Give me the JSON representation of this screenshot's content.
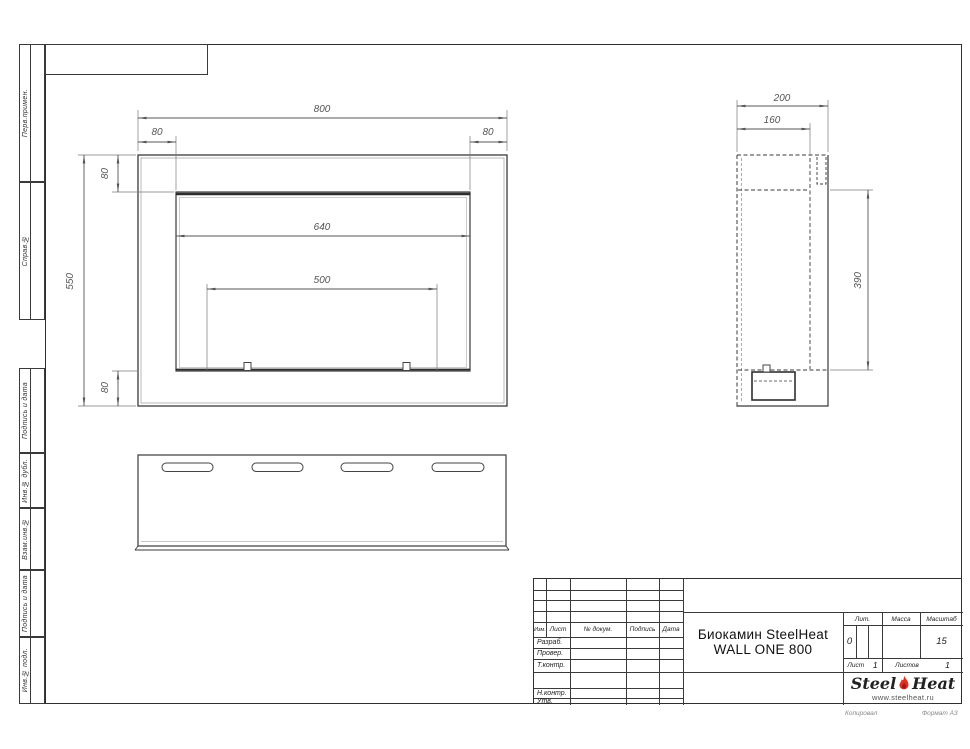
{
  "margin_labels": [
    "Перв.примен.",
    "Справ.№",
    "Подпись и дата",
    "Инв.№ дубл.",
    "Взам.инв.№",
    "Подпись и дата",
    "Инв.№ подл."
  ],
  "dims": {
    "front_width": "800",
    "front_flange_left": "80",
    "front_flange_right": "80",
    "front_flange_top": "80",
    "front_height": "550",
    "front_flange_bottom": "80",
    "front_opening_width": "640",
    "front_mount_span": "500",
    "side_depth": "200",
    "side_inner_depth": "160",
    "side_opening_height": "390"
  },
  "title_block": {
    "header": [
      "Изм.",
      "Лист",
      "№ докум.",
      "Подпись",
      "Дата"
    ],
    "rows": [
      "Разраб.",
      "Провер.",
      "Т.контр.",
      "Н.контр.",
      "Утв."
    ],
    "doc_title_line1": "Биокамин SteelHeat",
    "doc_title_line2": "WALL ONE 800",
    "lit_label": "Лит.",
    "lit_value": "0",
    "mass_label": "Масса",
    "scale_label": "Масштаб",
    "scale_value": "15",
    "sheet_label": "Лист",
    "sheet_value": "1",
    "sheets_label": "Листов",
    "sheets_value": "1",
    "logo_steel": "Steel",
    "logo_heat": "Heat",
    "logo_url": "www.steelheat.ru",
    "footer_copy": "Копировал",
    "footer_format": "Формат А3"
  },
  "colors": {
    "line": "#3a3a3a",
    "dim_line": "#6a6a6a",
    "flame_red": "#e03022",
    "flame_dark": "#a51717"
  }
}
